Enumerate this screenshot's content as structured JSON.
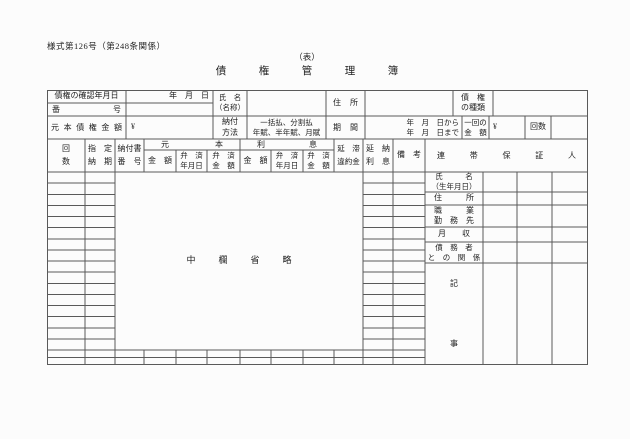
{
  "colors": {
    "line": "#5a5a5a",
    "text": "#222222",
    "background": "#fcfcfc"
  },
  "page": {
    "form_number": "様式第126号（第248条関係）",
    "side_label": "（表）",
    "title": "債　権　管　理　簿"
  },
  "info": {
    "confirm_date_label": "債権の確認年月日",
    "confirm_date_value": "年　月　日",
    "number_label": "番　号",
    "name_label_line1": "氏　名",
    "name_label_line2": "（名称）",
    "address_label": "住　所",
    "type_label_line1": "債　権",
    "type_label_line2": "の種類",
    "principal_label": "元本債権金額",
    "principal_currency": "¥",
    "method_label_line1": "納付",
    "method_label_line2": "方法",
    "method_value_line1": "一括払、分割払",
    "method_value_line2": "年賦、半年賦、月賦",
    "period_label": "期　間",
    "period_value_line1": "年　月　日から",
    "period_value_line2": "年　月　日まで",
    "installment_label_line1": "一回の",
    "installment_label_line2": "金　額",
    "installment_currency": "¥",
    "count_label": "回数"
  },
  "grid": {
    "kaisu_line1": "回",
    "kaisu_line2": "数",
    "shitei_line1": "指　定",
    "shitei_line2": "納　期",
    "nofusho_line1": "納付書",
    "nofusho_line2": "番　号",
    "principal_group": "元　本",
    "interest_group": "利　息",
    "amount_sub": "金　額",
    "repay_date_line1": "弁　済",
    "repay_date_line2": "年月日",
    "repay_amount_line1": "弁　済",
    "repay_amount_line2": "金　額",
    "entai_line1": "延　滞",
    "entai_line2": "違約金",
    "enno_line1": "延　納",
    "enno_line2": "利　息",
    "biko": "備　考",
    "guarantor_group": "連　帯　保　証　人",
    "omitted_note": "中　欄　省　略"
  },
  "guarantor": {
    "name_line1": "氏　　　名",
    "name_line2": "（生年月日）",
    "address": "住　　　所",
    "occupation_line1": "職　　　業",
    "occupation_line2": "勤　務　先",
    "income": "月　　収",
    "relation_line1": "債　務　者",
    "relation_line2": "と　の　関　係",
    "notes_char1": "記",
    "notes_char2": "事"
  }
}
